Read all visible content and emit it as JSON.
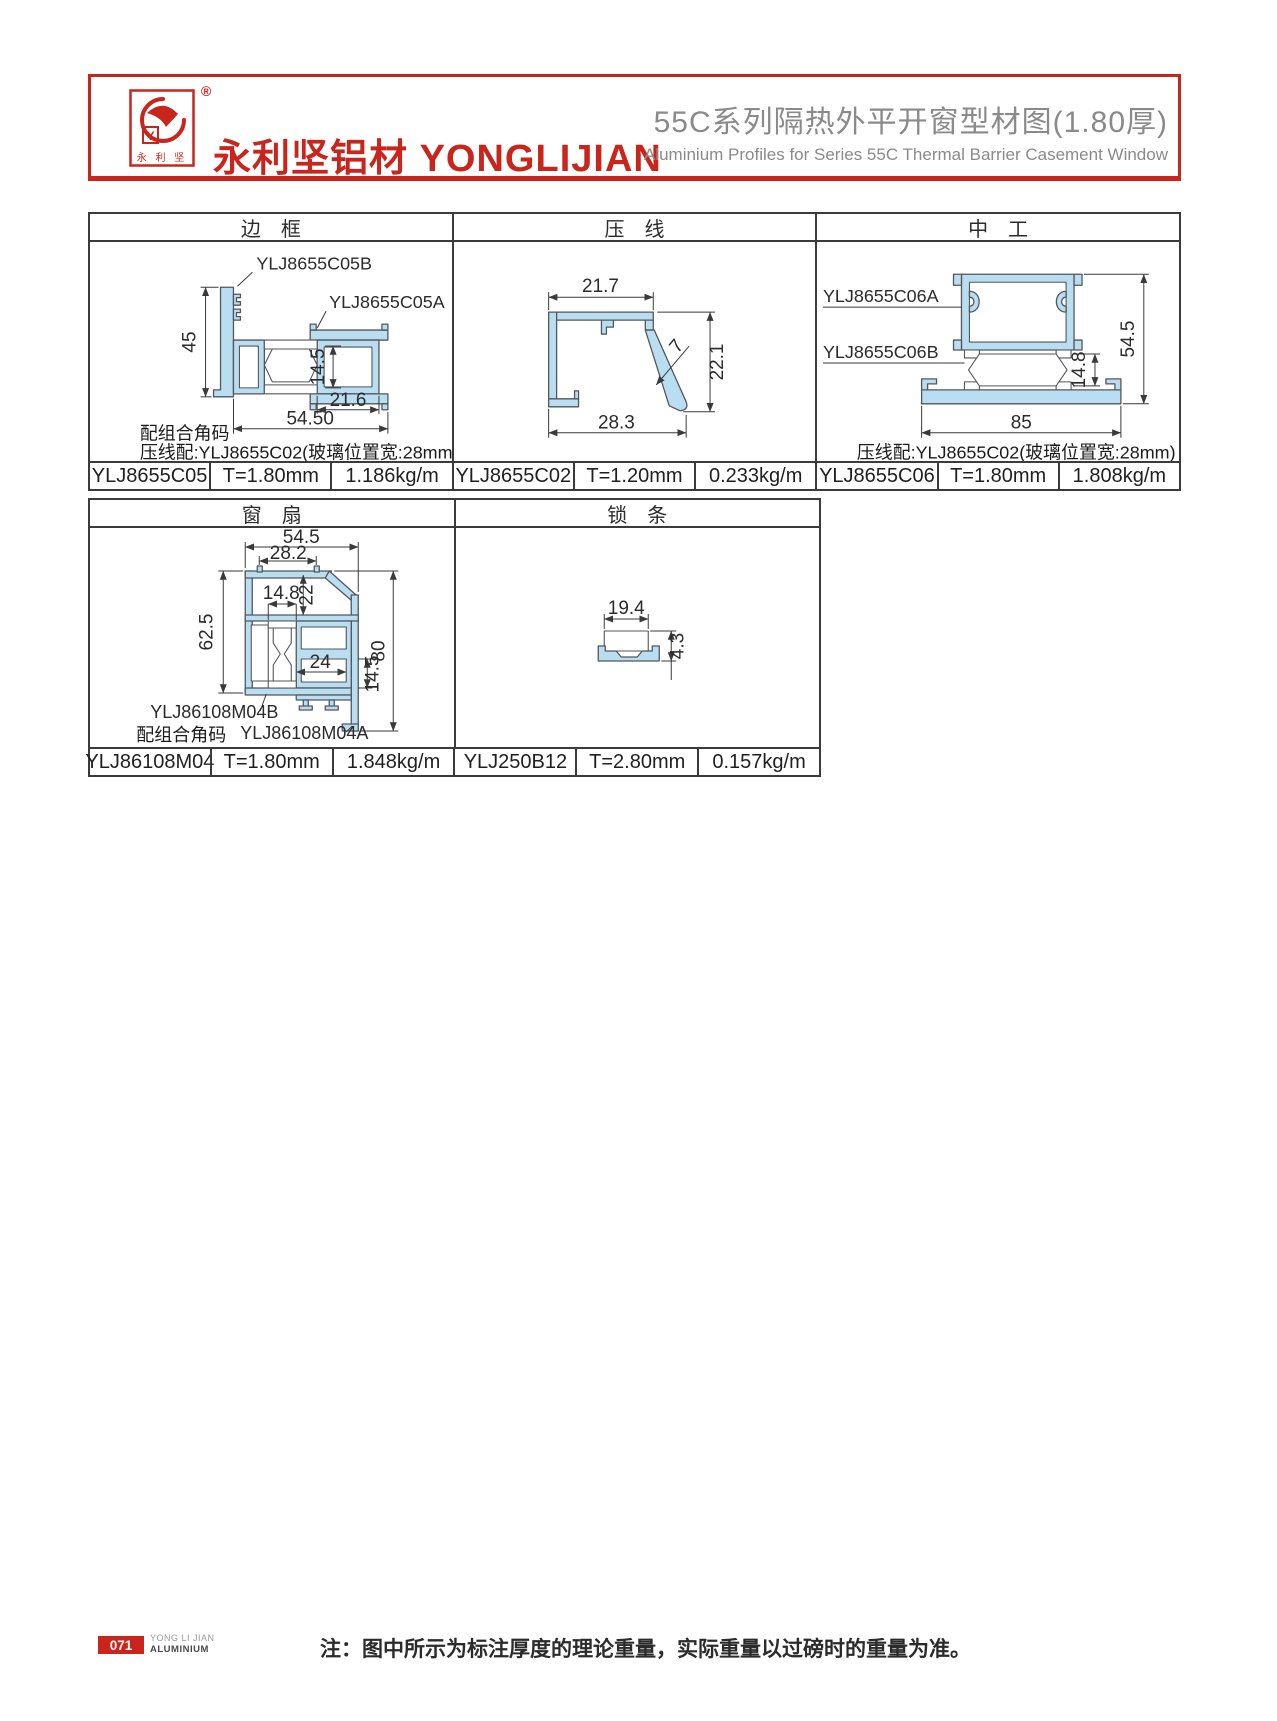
{
  "header": {
    "logo_mark_chars": "永 利 坚",
    "logo_monogram": "Y",
    "reg_mark": "®",
    "company_cn": "永利坚铝材",
    "company_en": "YONGLIJIAN",
    "title_cn": "55C系列隔热外平开窗型材图(1.80厚)",
    "title_en": "Aluminium Profiles for Series 55C Thermal Barrier Casement Window"
  },
  "colors": {
    "brand_red": "#c9251c",
    "profile_fill": "#b9def2",
    "profile_stroke": "#54565a",
    "table_border": "#3b3b3b",
    "title_gray": "#8a8a8a"
  },
  "table1": {
    "columns": [
      {
        "title": "边　框",
        "labels": {
          "part_b": "YLJ8655C05B",
          "part_a": "YLJ8655C05A"
        },
        "dims": {
          "frame_height": "45",
          "chamber_height": "14.5",
          "chamber_width": "21.6",
          "total_width": "54.50"
        },
        "notes": {
          "corner": "配组合角码",
          "bead": "压线配:YLJ8655C02(玻璃位置宽:28mm)"
        },
        "spec": {
          "code": "YLJ8655C05",
          "thickness": "T=1.80mm",
          "weight": "1.186kg/m"
        }
      },
      {
        "title": "压　线",
        "dims": {
          "top_width": "21.7",
          "face": "7",
          "height": "22.1",
          "bottom_width": "28.3"
        },
        "spec": {
          "code": "YLJ8655C02",
          "thickness": "T=1.20mm",
          "weight": "0.233kg/m"
        }
      },
      {
        "title": "中　工",
        "labels": {
          "part_a": "YLJ8655C06A",
          "part_b": "YLJ8655C06B"
        },
        "dims": {
          "height": "54.5",
          "break_height": "14.8",
          "width": "85"
        },
        "notes": {
          "bead": "压线配:YLJ8655C02(玻璃位置宽:28mm)"
        },
        "spec": {
          "code": "YLJ8655C06",
          "thickness": "T=1.80mm",
          "weight": "1.808kg/m"
        }
      }
    ]
  },
  "table2": {
    "columns": [
      {
        "title": "窗　扇",
        "labels": {
          "part_b": "YLJ86108M04B",
          "part_a": "YLJ86108M04A"
        },
        "dims": {
          "total_width": "54.5",
          "top_width": "28.2",
          "break_width": "14.8",
          "top_height": "22",
          "left_height": "62.5",
          "inner_width": "24",
          "inner_height": "14.5",
          "right_height": "80"
        },
        "notes": {
          "corner": "配组合角码"
        },
        "spec": {
          "code": "YLJ86108M04",
          "thickness": "T=1.80mm",
          "weight": "1.848kg/m"
        }
      },
      {
        "title": "锁　条",
        "dims": {
          "width": "19.4",
          "height": "4.3"
        },
        "spec": {
          "code": "YLJ250B12",
          "thickness": "T=2.80mm",
          "weight": "0.157kg/m"
        }
      }
    ]
  },
  "footer": {
    "page_number": "071",
    "brand_line1": "YONG LI JIAN",
    "brand_line2": "ALUMINIUM",
    "note": "注：图中所示为标注厚度的理论重量，实际重量以过磅时的重量为准。"
  }
}
